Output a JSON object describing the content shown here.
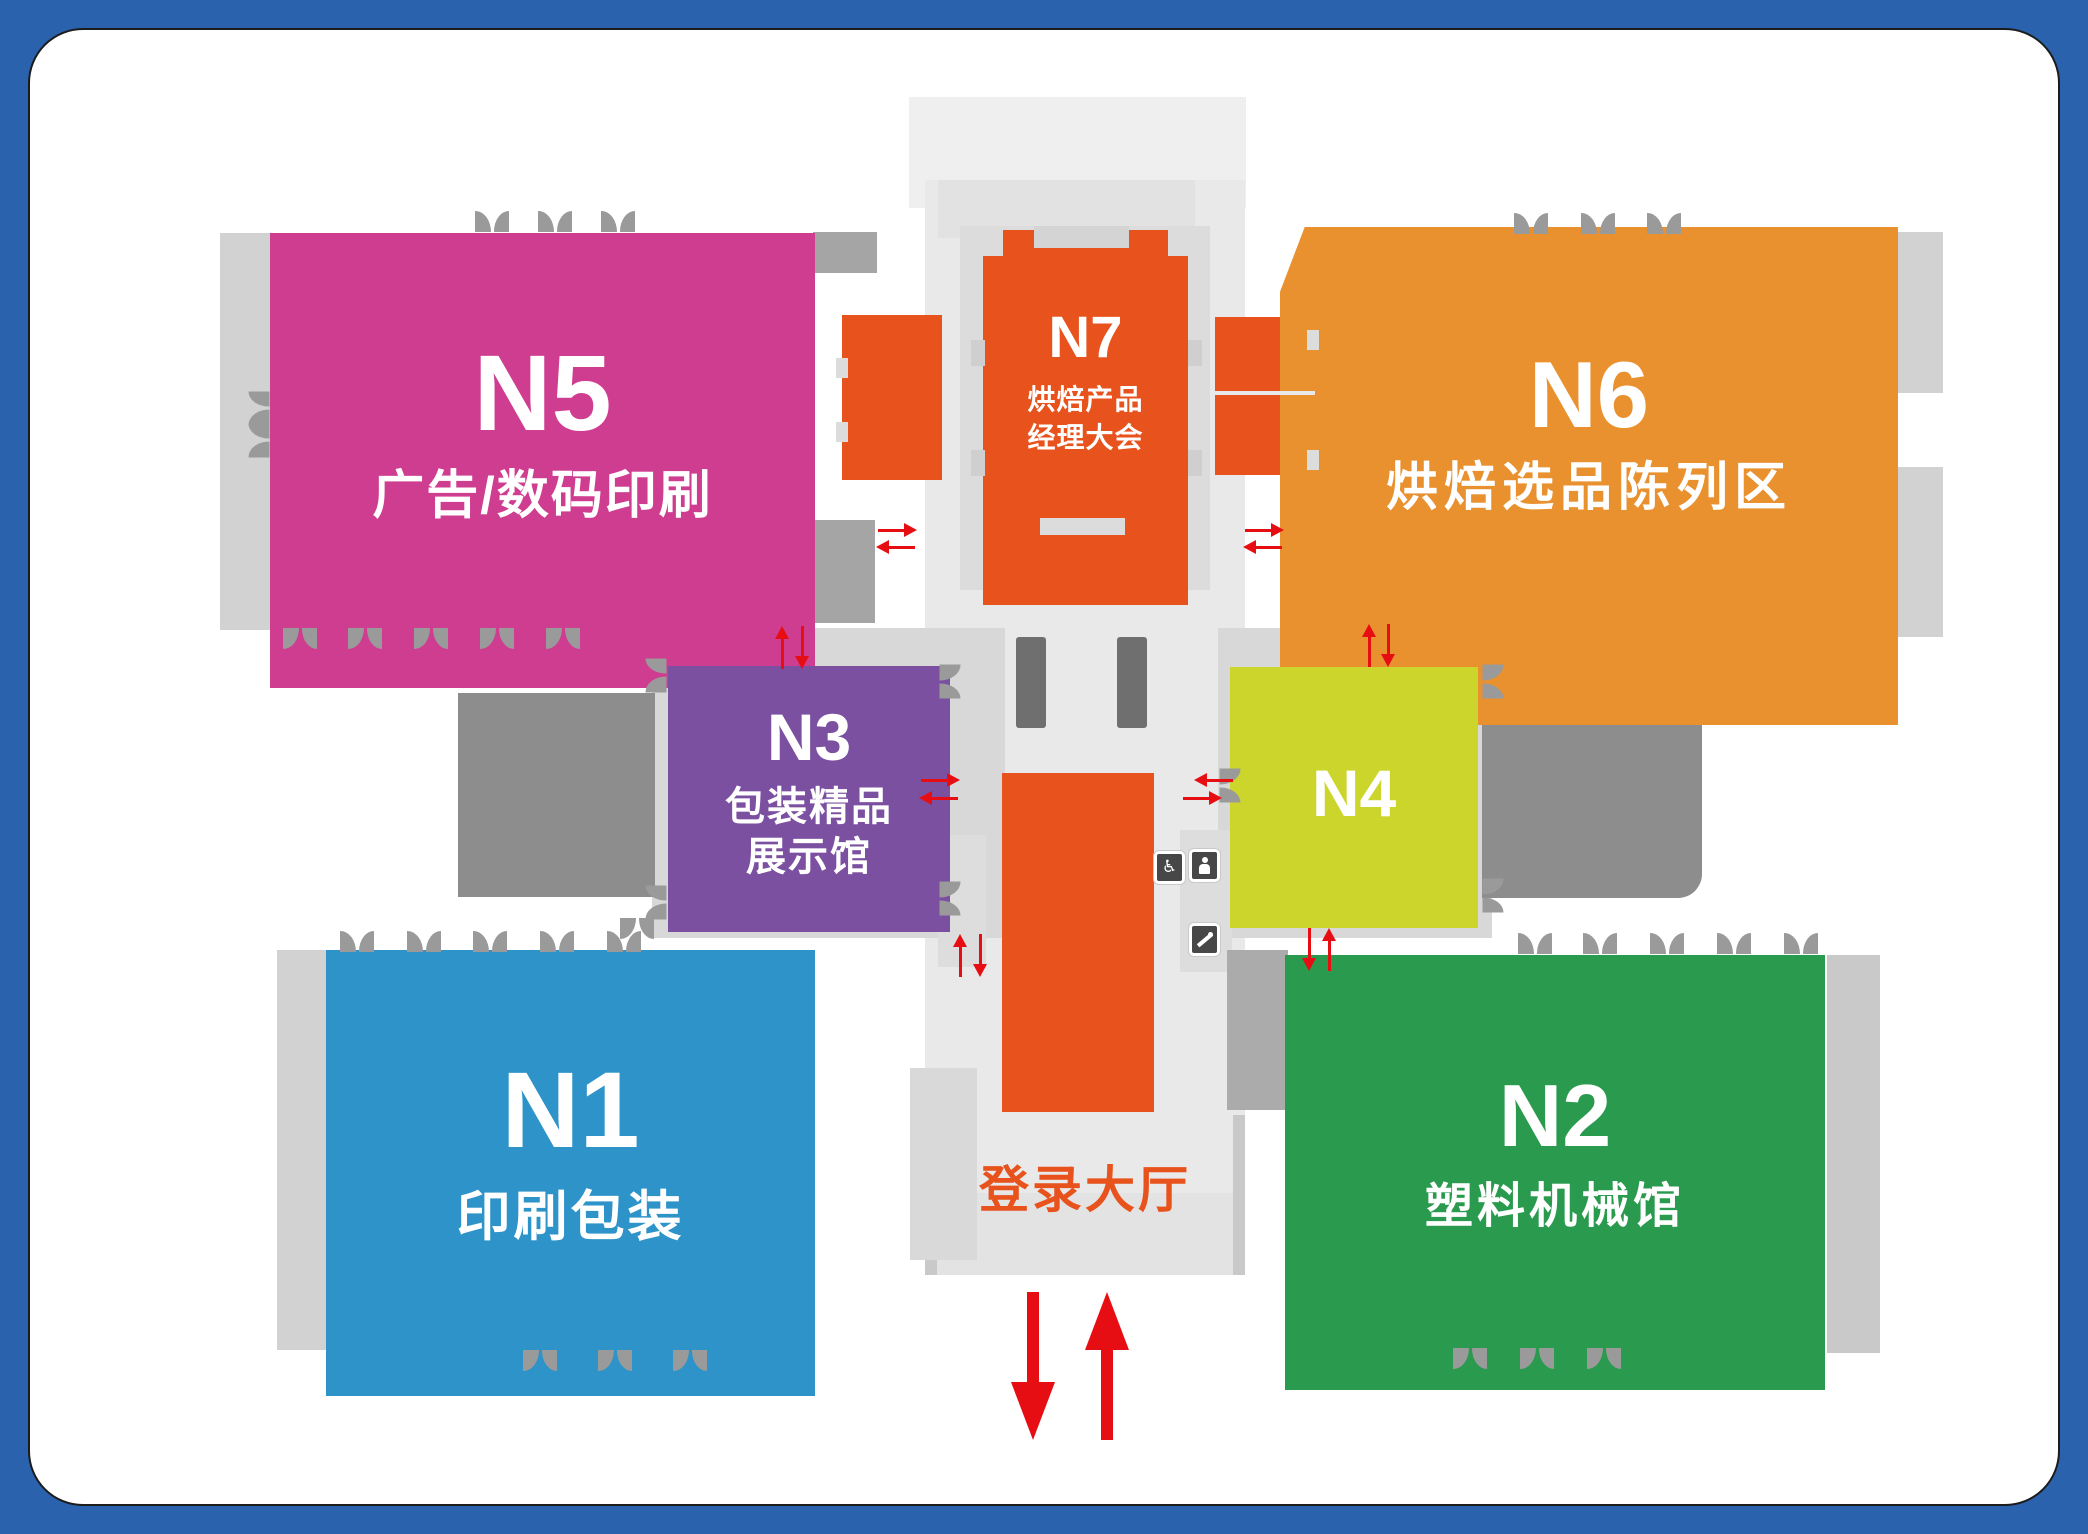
{
  "map": {
    "title_context": "exhibition-hall-floor-plan",
    "halls": [
      {
        "id": "n5",
        "label": "N5",
        "subtitle": "广告/数码印刷"
      },
      {
        "id": "n6",
        "label": "N6",
        "subtitle": "烘焙选品陈列区"
      },
      {
        "id": "n7",
        "label": "N7",
        "subtitle_line1": "烘焙产品",
        "subtitle_line2": "经理大会"
      },
      {
        "id": "n3",
        "label": "N3",
        "subtitle_line1": "包装精品",
        "subtitle_line2": "展示馆"
      },
      {
        "id": "n4",
        "label": "N4"
      },
      {
        "id": "n1",
        "label": "N1",
        "subtitle": "印刷包装"
      },
      {
        "id": "n2",
        "label": "N2",
        "subtitle": "塑料机械馆"
      }
    ],
    "lobby": {
      "label": "登录大厅"
    },
    "icons": [
      {
        "name": "wheelchair-icon"
      },
      {
        "name": "elevator-icon"
      },
      {
        "name": "escalator-icon"
      }
    ],
    "colors": {
      "frame_blue": "#2a62ae",
      "hall_n5": "#ce3d90",
      "hall_n6": "#e9912f",
      "hall_n7": "#e8521c",
      "hall_n3": "#7b50a0",
      "hall_n4": "#ccd52b",
      "hall_n1": "#2e93c8",
      "hall_n2": "#2a9a4f",
      "lobby_orange": "#e8521c",
      "label_orange": "#e8521c",
      "arrow_red": "#e60e12"
    }
  }
}
